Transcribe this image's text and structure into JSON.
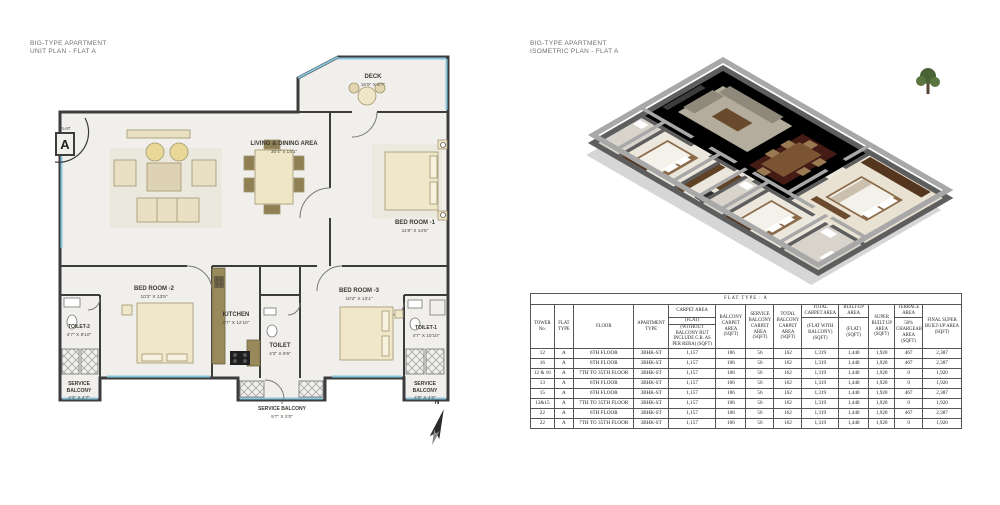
{
  "left_panel": {
    "title_line1": "BIG-TYPE APARTMENT",
    "title_line2": "UNIT PLAN - FLAT A",
    "flat_badge": {
      "top": "FLAT",
      "letter": "A"
    },
    "compass_label": "N",
    "rooms": {
      "deck": {
        "name": "DECK",
        "dims": "15'9\" X 6'7\""
      },
      "living": {
        "name": "LIVING & DINING AREA",
        "dims": "30'4\" x 14'1\""
      },
      "bed1": {
        "name": "BED ROOM -1",
        "dims": "11'8\" X 14'5\""
      },
      "bed2": {
        "name": "BED ROOM -2",
        "dims": "10'2\" X 13'5\""
      },
      "bed3": {
        "name": "BED ROOM -3",
        "dims": "10'2\" X 13'1\""
      },
      "kitchen": {
        "name": "KITCHEN",
        "dims": "6'7\" X 12'10\""
      },
      "toilet": {
        "name": "TOILET",
        "dims": "4'3\" X 9'6\""
      },
      "toilet1": {
        "name": "TOILET-1",
        "dims": "4'7\" X 10'10\""
      },
      "toilet2": {
        "name": "TOILET-2",
        "dims": "4'7\" X 8'10\""
      },
      "sb_left": {
        "lines": [
          "SERVICE",
          "BALCONY"
        ],
        "dims": "4'3\" X 4'7\""
      },
      "sb_mid": {
        "lines": [
          "SERVICE BALCONY"
        ],
        "dims": "9'7\" X 2'0\""
      },
      "sb_right": {
        "lines": [
          "SERVICE",
          "BALCONY"
        ],
        "dims": "4'9\" X 4'3\""
      }
    }
  },
  "right_panel": {
    "title_line1": "BIG-TYPE APARTMENT",
    "title_line2": "ISOMETRIC PLAN - FLAT A"
  },
  "table": {
    "caption": "FLAT TYPE : A",
    "h": {
      "tower": "TOWER No.",
      "flat": "FLAT TYPE",
      "floor": "FLOOR",
      "apt": "APARTMENT TYPE",
      "carpet_top": "CARPET AREA",
      "carpet_mid": "(FLAT)",
      "carpet_bottom": "(WITHOUT BALCONY BUT INCLUDE C.B. AS PER RERA) (SQFT)",
      "balcony": "BALCONY CARPET AREA (SQFT)",
      "service": "SERVICE BALCONY CARPET AREA (SQFT)",
      "total_balcony": "TOTAL BALCONY CARPET AREA (SQFT)",
      "total_carpet_top": "TOTAL CARPET AREA",
      "total_carpet_sub": "(FLAT WITH BALCONY) (SQFT)",
      "builtup_top": "BUILT-UP AREA",
      "builtup_sub": "(FLAT) (SQFT)",
      "super_built": "SUPER BUILT UP AREA (SQFT)",
      "terrace_top": "TERRACE AREA",
      "terrace_sub": "50% CHARGEABLE AREA (SQFT)",
      "final": "FINAL SUPER BUILT-UP AREA (SQFT)"
    },
    "rows": [
      [
        "12",
        "A",
        "6TH FLOOR",
        "3BHK-ST",
        "1,157",
        "106",
        "56",
        "162",
        "1,319",
        "1,440",
        "1,920",
        "467",
        "2,387"
      ],
      [
        "16",
        "A",
        "6TH FLOOR",
        "3BHK-ST",
        "1,157",
        "106",
        "56",
        "162",
        "1,319",
        "1,440",
        "1,920",
        "467",
        "2,387"
      ],
      [
        "12 & 16",
        "A",
        "7TH TO 35TH FLOOR",
        "3BHK-ST",
        "1,157",
        "106",
        "56",
        "162",
        "1,319",
        "1,440",
        "1,920",
        "0",
        "1,920"
      ],
      [
        "13",
        "A",
        "6TH FLOOR",
        "3BHK-ST",
        "1,157",
        "106",
        "56",
        "162",
        "1,319",
        "1,440",
        "1,920",
        "0",
        "1,920"
      ],
      [
        "15",
        "A",
        "6TH FLOOR",
        "3BHK-ST",
        "1,157",
        "106",
        "56",
        "162",
        "1,319",
        "1,440",
        "1,920",
        "467",
        "2,387"
      ],
      [
        "13&15",
        "A",
        "7TH TO 35TH FLOOR",
        "3BHK-ST",
        "1,157",
        "106",
        "56",
        "162",
        "1,319",
        "1,440",
        "1,920",
        "0",
        "1,920"
      ],
      [
        "22",
        "A",
        "6TH FLOOR",
        "3BHK-ST",
        "1,157",
        "106",
        "56",
        "162",
        "1,319",
        "1,440",
        "1,920",
        "467",
        "2,387"
      ],
      [
        "22",
        "A",
        "7TH TO 35TH FLOOR",
        "3BHK-ST",
        "1,157",
        "106",
        "56",
        "162",
        "1,319",
        "1,440",
        "1,920",
        "0",
        "1,920"
      ]
    ]
  },
  "colors": {
    "wall": "#3c3c3c",
    "floor": "#f0efeb",
    "window": "#86c5dd",
    "furniture": "#e9e0c4",
    "iso_wall": "#5e5e5e",
    "iso_floor": "#ece7dc"
  }
}
